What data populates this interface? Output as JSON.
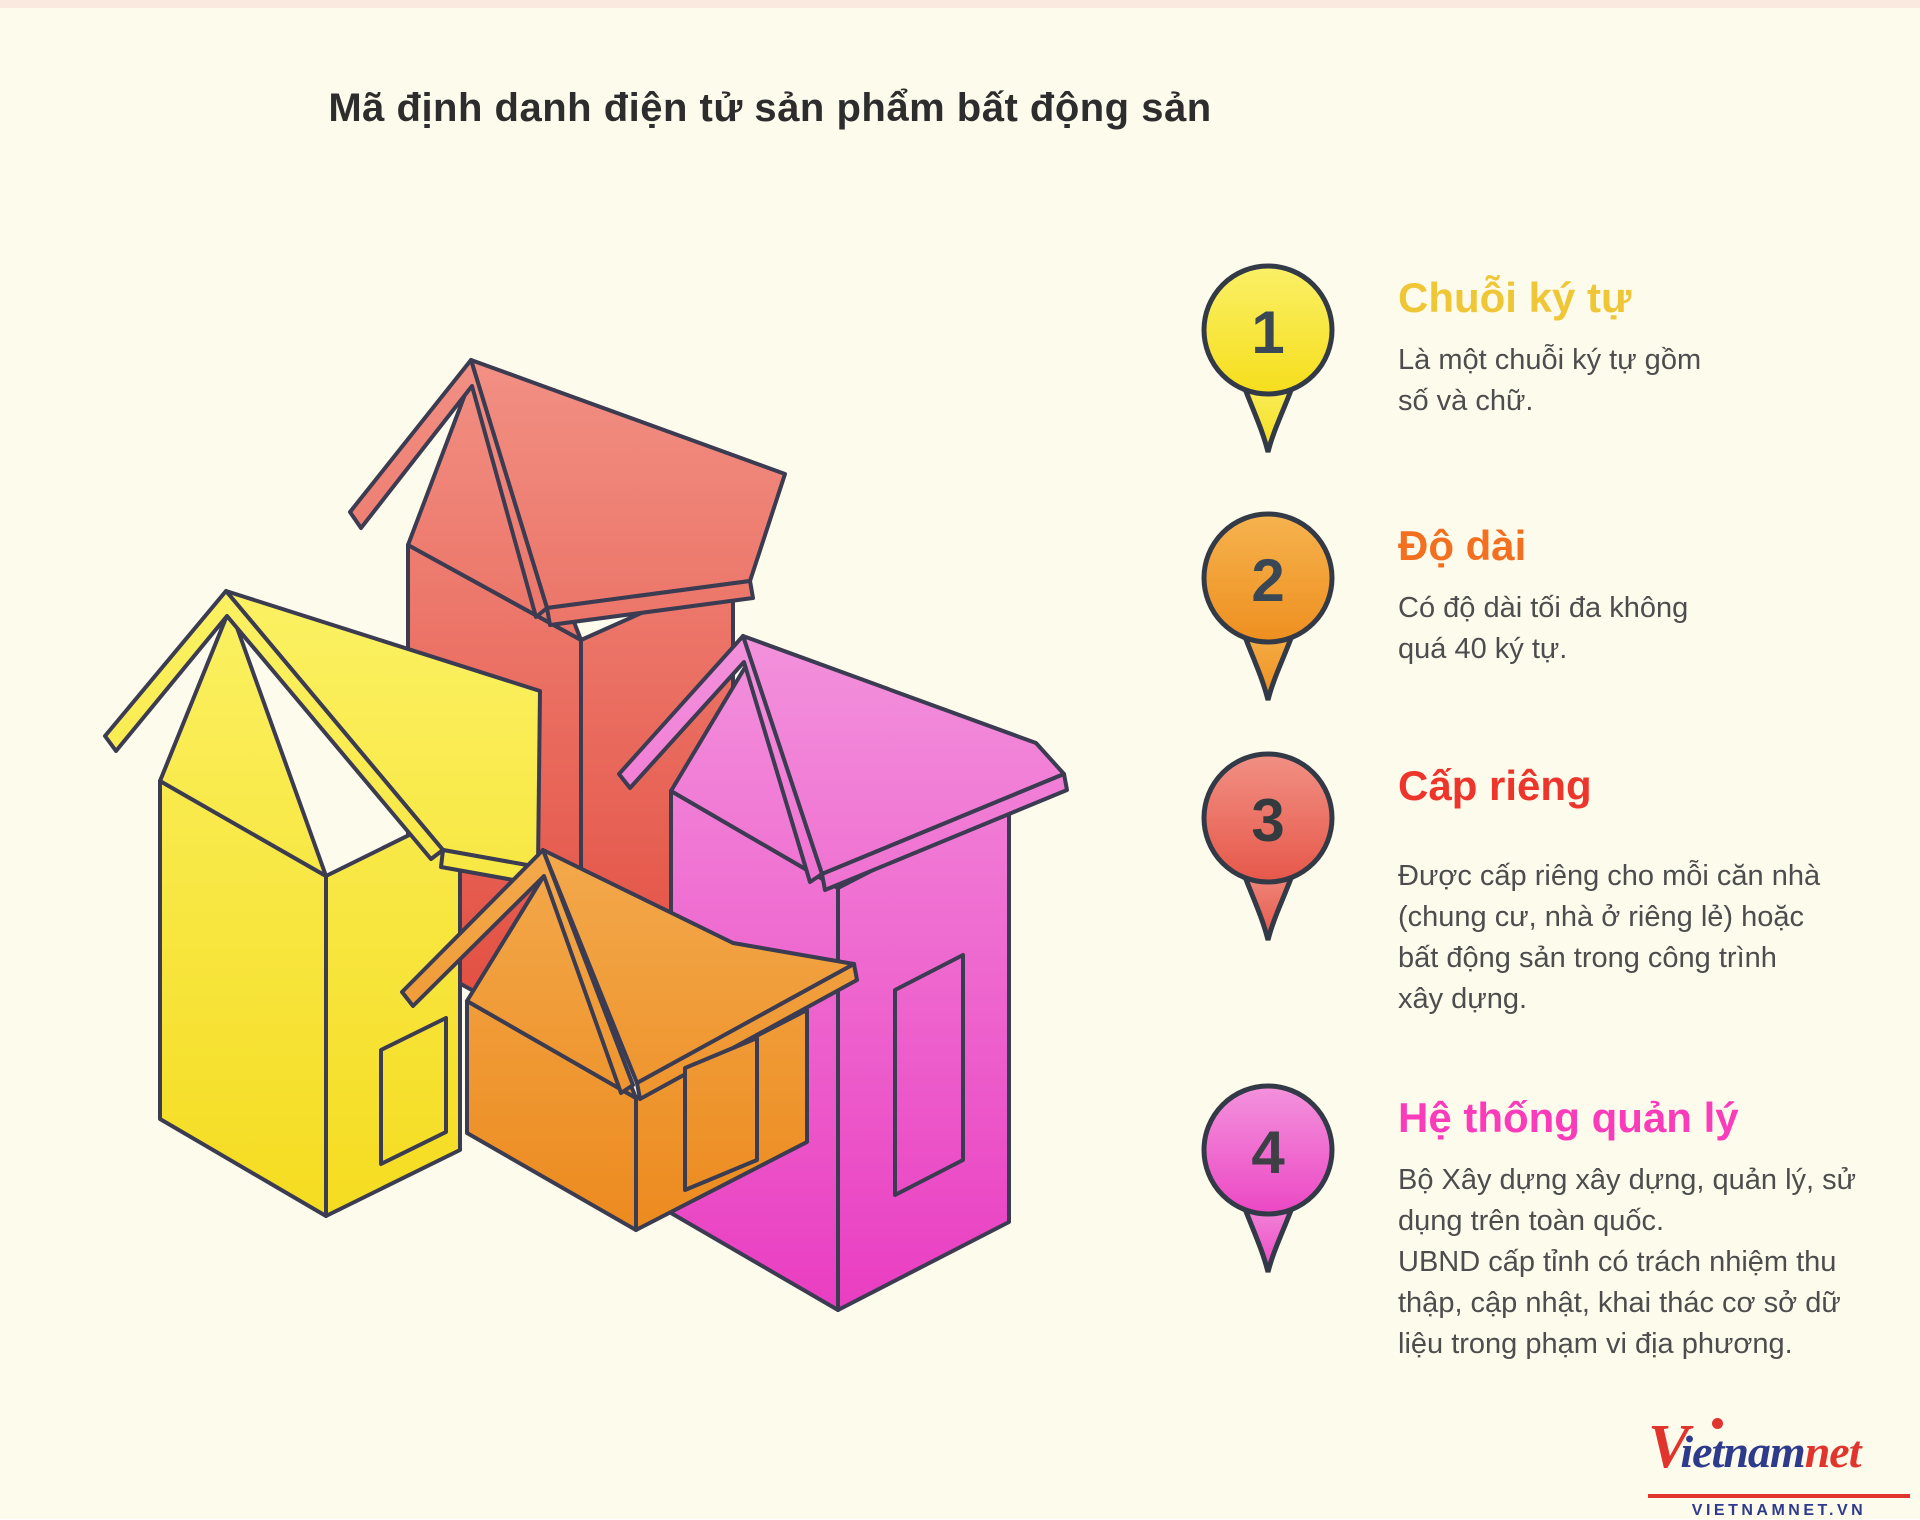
{
  "page": {
    "background": "#FDFBEC",
    "top_border": "#FAE9DE",
    "title": "Mã định danh điện tử sản phẩm bất động sản",
    "title_color": "#2D2D2D",
    "body_text_color": "#4D4D4D"
  },
  "items": [
    {
      "number": "1",
      "label": "Chuỗi ký tự",
      "description": "Là một chuỗi ký tự gồm\nsố và chữ.",
      "accent": "#EFC636",
      "badge_light": "#FAF067",
      "badge_dark": "#F6DE1C",
      "badge_outline": "#333A47",
      "number_color": "#3A4754"
    },
    {
      "number": "2",
      "label": "Độ dài",
      "description": "Có độ dài tối đa không\nquá 40 ký tự.",
      "accent": "#F2701F",
      "badge_light": "#F6B34F",
      "badge_dark": "#EE8F1F",
      "badge_outline": "#333A47",
      "number_color": "#3A4754"
    },
    {
      "number": "3",
      "label": "Cấp riêng",
      "description": "Được cấp riêng cho mỗi căn nhà\n(chung cư, nhà ở riêng lẻ) hoặc\nbất động sản trong công trình\nxây dựng.",
      "accent": "#EE352C",
      "badge_light": "#F19084",
      "badge_dark": "#E6584A",
      "badge_outline": "#333A47",
      "number_color": "#333B3F"
    },
    {
      "number": "4",
      "label": "Hệ thống quản lý",
      "description": "Bộ Xây dựng xây dựng, quản lý, sử\ndụng trên toàn quốc.\nUBND cấp tỉnh có trách nhiệm thu\nthập, cập nhật, khai thác cơ sở dữ\nliệu trong phạm vi địa phương.",
      "accent": "#FA3BBA",
      "badge_light": "#F392DC",
      "badge_dark": "#EC48C4",
      "badge_outline": "#333A47",
      "number_color": "#3F3F46"
    }
  ],
  "illustration": {
    "stroke": "#3B3B52",
    "houses": [
      {
        "name": "red-house",
        "light": "#F29084",
        "dark": "#E14A3C"
      },
      {
        "name": "yellow-house",
        "light": "#FBF163",
        "dark": "#F5DC20"
      },
      {
        "name": "magenta-house",
        "light": "#F392DC",
        "dark": "#E93CC1"
      },
      {
        "name": "orange-house",
        "light": "#F3A94C",
        "dark": "#EC8A1E"
      }
    ]
  },
  "logo": {
    "v_mark": "V",
    "word_blue": "ietnam",
    "word_red": "net",
    "site": "VIETNAMNET.VN",
    "blue": "#2E3B8C",
    "red": "#E0342C"
  }
}
